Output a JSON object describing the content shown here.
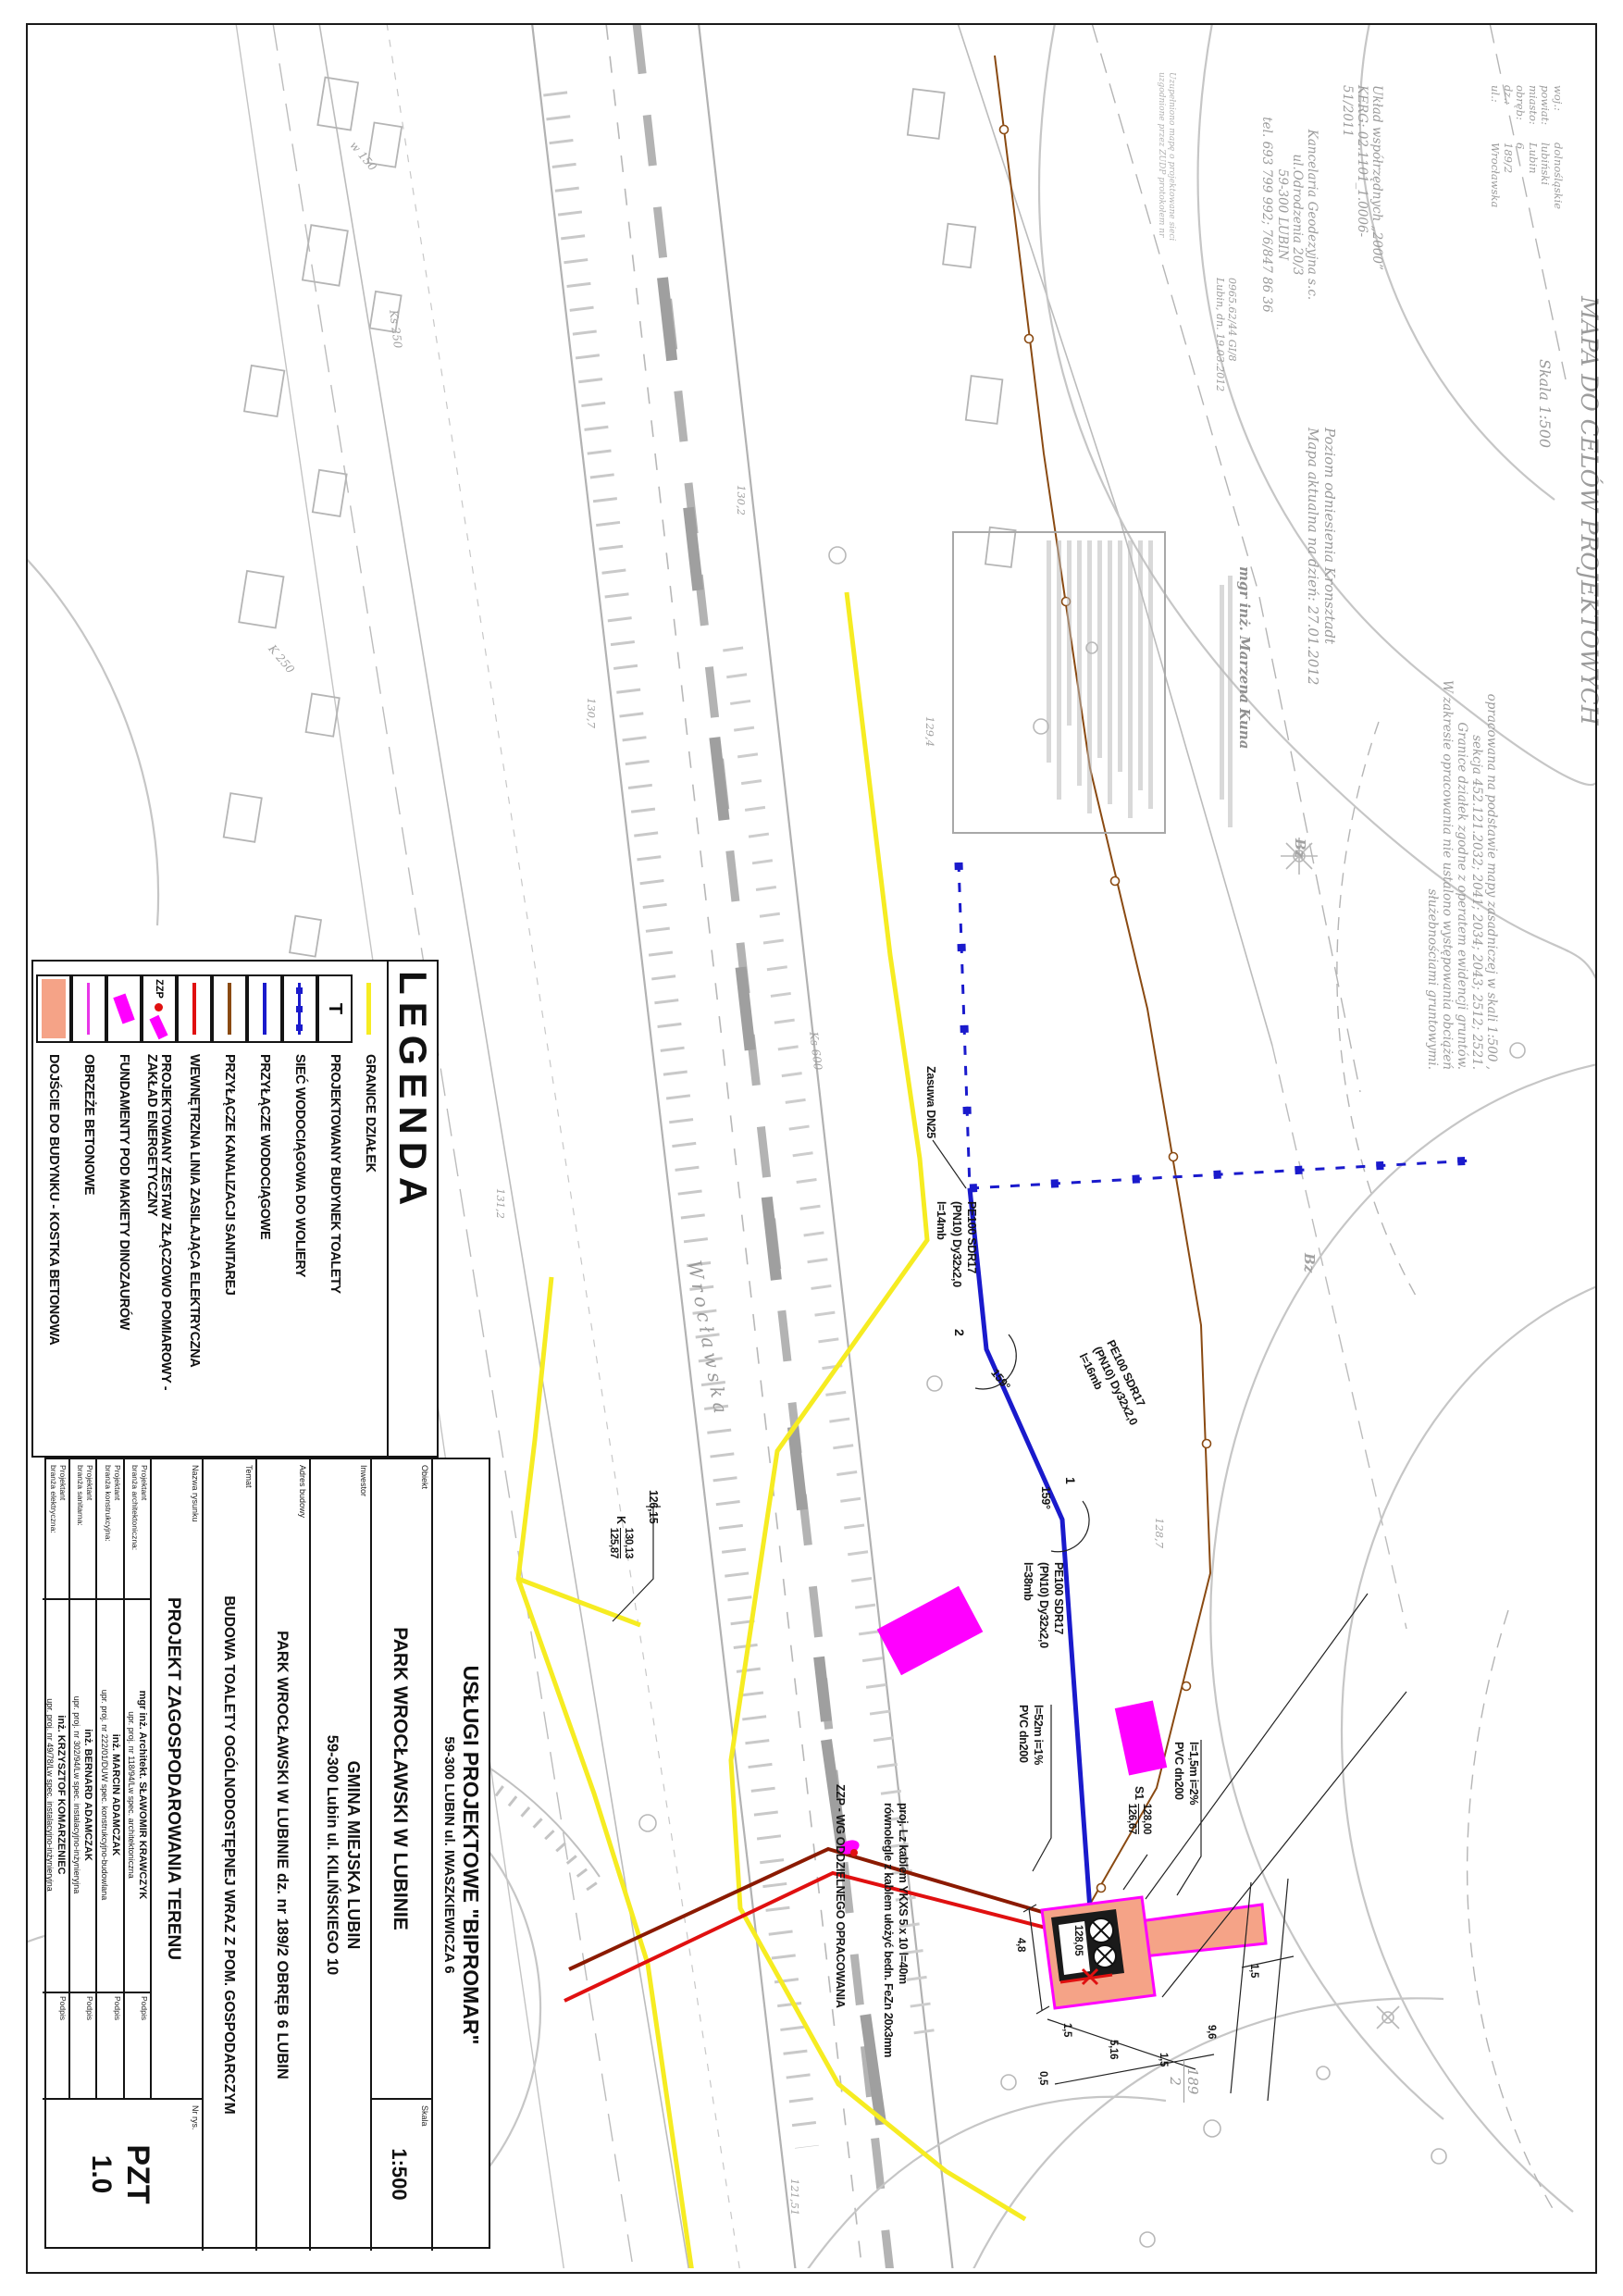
{
  "header": {
    "title": "MAPA DO CELÓW PROJEKTOWYCH",
    "scale": "Skala 1:500",
    "meta": [
      {
        "label": "woj.:",
        "value": "dolnośląskie"
      },
      {
        "label": "powiat:",
        "value": "lubiński"
      },
      {
        "label": "miasto:",
        "value": "Lubin"
      },
      {
        "label": "obręb:",
        "value": "6"
      },
      {
        "label": "dz.:",
        "value": "189/2"
      },
      {
        "label": "ul.:",
        "value": "Wrocławska"
      }
    ],
    "description_lines": [
      "opracowana na podstawie mapy zasadniczej w skali 1:500 ,",
      "sekcja 452.121.2032; 2041; 2034; 2043; 2512; 2521.",
      "Granice działek zgodne z operatem ewidencji gruntów.",
      "W zakresie opracowania nie ustalono występowania obciążeń",
      "służebnościami gruntowymi."
    ],
    "coord_system_line1": "Układ współrzędnych „2000”",
    "coord_system_line2": "KERG: 02.1101_1.0006-51/2011",
    "office_lines": [
      "Kancelaria Geodezyjna s.c.",
      "ul.Odrodzenia 20/3",
      "59-300  LUBIN",
      "tel. 693 799 992;  76/847 86 36"
    ],
    "update_note_line1": "Uzupełniono mapę o projektowane sieci",
    "update_note_line2": "uzgodnione przez ZUDP protokołem nr",
    "handwritten_line1": "0965.62/44  GI/8",
    "handwritten_line2": "Lubin, dn. 19.03.2012",
    "datum_line1": "Poziom odniesienia Kronsztadt",
    "datum_line2": "Mapa aktualna na dzień: 27.01.2012",
    "surveyor_name": "mgr inż. Marzena Kuna"
  },
  "legend": {
    "title": "LEGENDA",
    "t_symbol": "T",
    "zzp_symbol_text": "ZZP",
    "items": [
      {
        "label": "GRANICE DZIAŁEK"
      },
      {
        "label": "PROJEKTOWANY BUDYNEK TOALETY"
      },
      {
        "label": "SIEĆ WODOCIĄGOWA DO WOLIERY"
      },
      {
        "label": "PRZYŁĄCZE WODOCIĄGOWE"
      },
      {
        "label": "PRZYŁĄCZE KANALIZACJI SANITAREJ"
      },
      {
        "label": "WEWNĘTRZNA LINIA ZASILAJĄCA ELEKTRYCZNA"
      },
      {
        "label": "PROJEKTOWANY ZESTAW ZŁĄCZOWO POMIAROWY - ZAKŁAD ENERGETYCZNY"
      },
      {
        "label": "FUNDAMENTY POD MAKIETY DINOZAURÓW"
      },
      {
        "label": "OBRZEŻE BETONOWE"
      },
      {
        "label": "DOJŚCIE DO BUDYNKU - KOSTKA BETONOWA"
      }
    ]
  },
  "title_block": {
    "company_line1": "USŁUGI PROJEKTOWE \"BIPROMAR\"",
    "company_line2": "59-300 LUBIN ul. IWASZKIEWICZA 6",
    "obiekt_label": "Obiekt",
    "obiekt_value": "PARK WROCŁAWSKI W LUBINIE",
    "skala_label": "Skala",
    "skala_value": "1:500",
    "inwestor_label": "Inwestor",
    "inwestor_value1": "GMINA MIEJSKA LUBIN",
    "inwestor_value2": "59-300 Lubin ul. KILIŃSKIEGO 10",
    "adres_label": "Adres budowy",
    "adres_value": "PARK WROCŁAWSKI W LUBINIE dz. nr 189/2 OBRĘB 6 LUBIN",
    "temat_label": "Temat",
    "temat_value": "BUDOWA TOALETY OGÓLNODOSTĘPNEJ WRAZ Z POM. GOSPODARCZYM",
    "rysunek_label": "Nazwa rysunku",
    "rysunek_value": "PROJEKT ZAGOSPODAROWANIA TERENU",
    "nr_label": "Nr rys.",
    "nr_value1": "PZT",
    "nr_value2": "1.0",
    "podpis_label": "Podpis",
    "designers": [
      {
        "role1": "Projektant",
        "role2": "branża architektoniczna:",
        "name": "mgr inż. Architekt. SŁAWOMIR KRAWCZYK",
        "cert": "upr. proj. nr 118/94/Lw spec. architektoniczna"
      },
      {
        "role1": "Projektant",
        "role2": "branża konstrukcyjna:",
        "name": "inż. MARCIN ADAMCZAK",
        "cert": "upr. proj. nr 222/01/DUW spec. konstrukcyjno-budowlana"
      },
      {
        "role1": "Projektant",
        "role2": "branża sanitarna:",
        "name": "inż. BERNARD ADAMCZAK",
        "cert": "upr. proj. nr 302/94/Lw spec. instalacyjno-inżynieryjna"
      },
      {
        "role1": "Projektant",
        "role2": "branża elektryczna:",
        "name": "inż. KRZYSZTOF KOMARZENIEC",
        "cert": "upr. proj. nr 49/78/Lw spec. instalacyjno-inżynieryjna"
      }
    ]
  },
  "map": {
    "street_name": "Wrocławska",
    "valve_label": "Zasuwa DN25",
    "pipe1": {
      "l1": "PE100 SDR17",
      "l2": "(PN10) Dy32x2,0",
      "l3": "l=14mb"
    },
    "pipe2": {
      "l1": "PE100 SDR17",
      "l2": "(PN10) Dy32x2,0",
      "l3": "l=16mb"
    },
    "pipe3": {
      "l1": "PE100 SDR17",
      "l2": "(PN10) Dy32x2,0",
      "l3": "l=38mb"
    },
    "angle1": "159°",
    "angle2": "159°",
    "node1": "1",
    "node2": "2",
    "sewer1": {
      "l1": "PVC dn200",
      "l2": "l=52m i=1%"
    },
    "sewer2": {
      "l1": "PVC dn200",
      "l2": "l=1,5m i=2%"
    },
    "manhole_s": {
      "name": "S1",
      "invert_top": "128,00",
      "invert_bottom": "126,67"
    },
    "manhole_k": {
      "name": "K",
      "invert_top": "130,13",
      "invert_bottom": "125,87"
    },
    "ground_level": "126,15",
    "building_level": "128,05",
    "zzp_note": "ZZP - WG ODDZIELNEGO OPRACOWANIA",
    "cable_note_line1": "proj. Lz kablem YKXS 5 x 10  l=40m",
    "cable_note_line2": "równolegle z kablem ułożyć bedn. FeZn 20x3mm",
    "parcel_number": "189",
    "parcel_sub": "2",
    "dims": [
      "4,8",
      "1,5",
      "5,16",
      "1,5",
      "0,5",
      "9,6",
      "1,5"
    ],
    "bz_label": "Bz",
    "utility_labels": [
      "Ks 600",
      "Ks 250",
      "K 250",
      "w 150",
      "eNN"
    ],
    "spot_heights": [
      "130,2",
      "131,2",
      "130,7",
      "124,99",
      "123,22",
      "121,51",
      "128,7",
      "129,4"
    ]
  }
}
